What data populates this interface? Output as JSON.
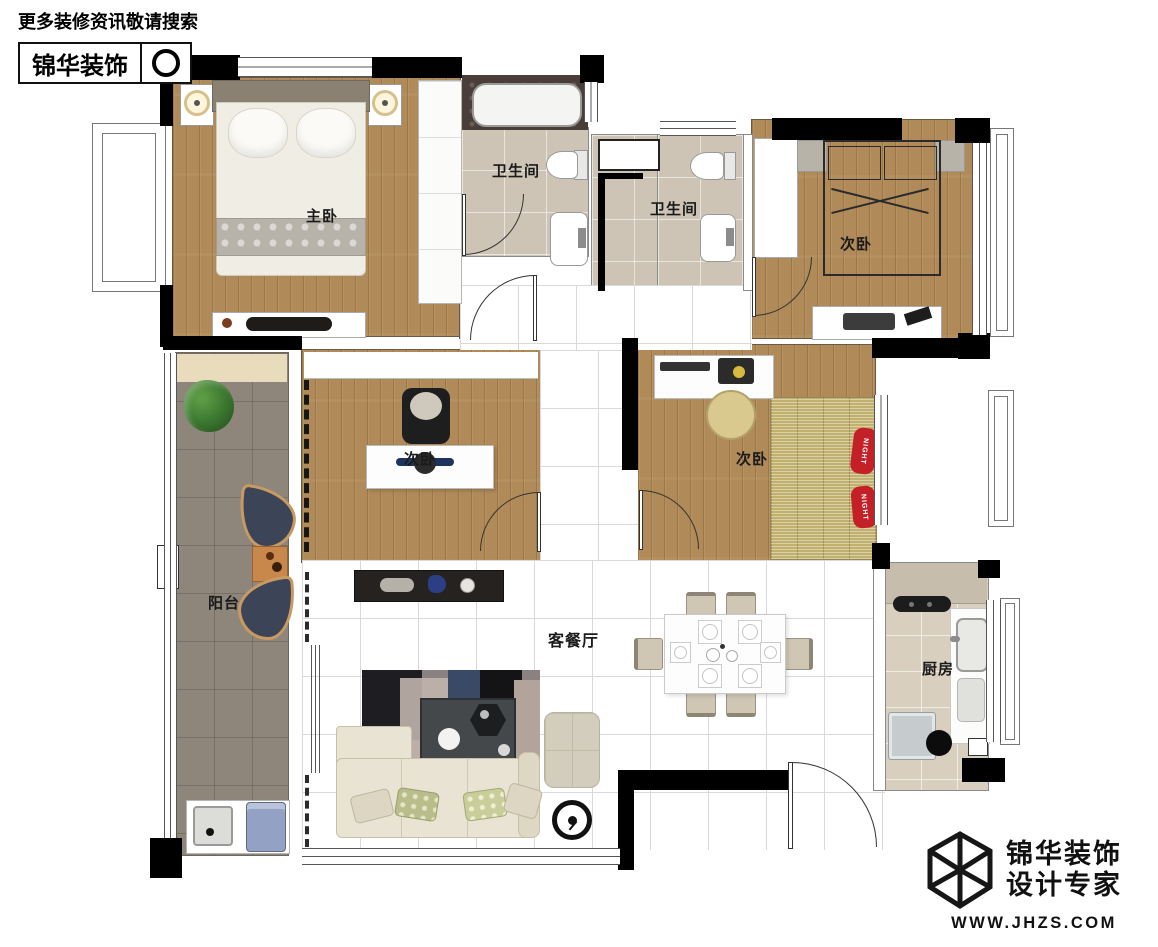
{
  "header": {
    "tagline": "更多装修资讯敬请搜索",
    "brand": "锦华装饰"
  },
  "rooms": {
    "master_bedroom": {
      "label": "主卧"
    },
    "bathroom_1": {
      "label": "卫生间"
    },
    "bathroom_2": {
      "label": "卫生间"
    },
    "bedroom_top_right": {
      "label": "次卧"
    },
    "bedroom_study": {
      "label": "次卧"
    },
    "bedroom_tatami": {
      "label": "次卧",
      "pillow_text": "NIGHT"
    },
    "balcony": {
      "label": "阳台"
    },
    "living_dining": {
      "label": "客餐厅"
    },
    "kitchen": {
      "label": "厨房"
    }
  },
  "footer": {
    "brand": "锦华装饰",
    "subtitle": "设计专家",
    "website": "WWW.JHZS.COM"
  },
  "icons": {
    "search": "magnifier-circle",
    "logo": "hexagon-cube-wireframe"
  },
  "colors": {
    "wall": "#000000",
    "wood_floor": "#b08a58",
    "bath_tile": "#cdc4b5",
    "balcony_tile": "#8f867b",
    "kitchen_tile": "#d9cfbf",
    "tatami_mat": "#c2b06e",
    "pillow_red": "#c32127",
    "chair_navy": "#3b4557",
    "sofa_beige": "#e9e3d3"
  }
}
